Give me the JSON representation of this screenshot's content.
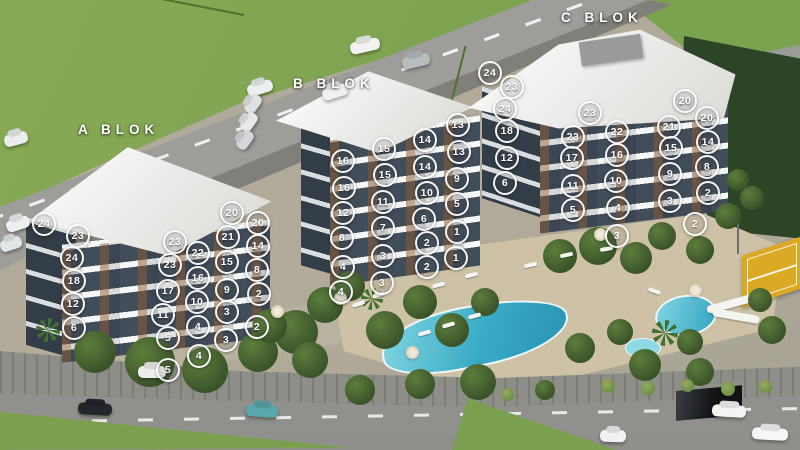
{
  "scene_title": "Residential complex 3D site plan with apartment unit markers",
  "blocks": [
    {
      "id": "A",
      "label": "A BLOK",
      "units": [
        {
          "n": "24",
          "x": 44,
          "y": 224
        },
        {
          "n": "23",
          "x": 78,
          "y": 236
        },
        {
          "n": "24",
          "x": 72,
          "y": 258
        },
        {
          "n": "18",
          "x": 74,
          "y": 281
        },
        {
          "n": "12",
          "x": 73,
          "y": 304
        },
        {
          "n": "6",
          "x": 74,
          "y": 328
        },
        {
          "n": "23",
          "x": 175,
          "y": 242
        },
        {
          "n": "23",
          "x": 170,
          "y": 265
        },
        {
          "n": "17",
          "x": 168,
          "y": 291
        },
        {
          "n": "11",
          "x": 163,
          "y": 315
        },
        {
          "n": "5",
          "x": 168,
          "y": 338
        },
        {
          "n": "5",
          "x": 168,
          "y": 370
        },
        {
          "n": "22",
          "x": 198,
          "y": 253
        },
        {
          "n": "16",
          "x": 198,
          "y": 278
        },
        {
          "n": "10",
          "x": 197,
          "y": 302
        },
        {
          "n": "4",
          "x": 198,
          "y": 327
        },
        {
          "n": "4",
          "x": 199,
          "y": 356
        },
        {
          "n": "20",
          "x": 232,
          "y": 213
        },
        {
          "n": "21",
          "x": 228,
          "y": 237
        },
        {
          "n": "15",
          "x": 227,
          "y": 262
        },
        {
          "n": "9",
          "x": 227,
          "y": 290
        },
        {
          "n": "3",
          "x": 227,
          "y": 312
        },
        {
          "n": "3",
          "x": 226,
          "y": 340
        },
        {
          "n": "20",
          "x": 258,
          "y": 223
        },
        {
          "n": "14",
          "x": 258,
          "y": 246
        },
        {
          "n": "8",
          "x": 257,
          "y": 270
        },
        {
          "n": "2",
          "x": 259,
          "y": 294
        },
        {
          "n": "2",
          "x": 257,
          "y": 327
        }
      ]
    },
    {
      "id": "B",
      "label": "B BLOK",
      "units": [
        {
          "n": "16",
          "x": 343,
          "y": 161
        },
        {
          "n": "16",
          "x": 344,
          "y": 188
        },
        {
          "n": "12",
          "x": 343,
          "y": 213
        },
        {
          "n": "8",
          "x": 342,
          "y": 238
        },
        {
          "n": "4",
          "x": 343,
          "y": 267
        },
        {
          "n": "4",
          "x": 341,
          "y": 292
        },
        {
          "n": "15",
          "x": 384,
          "y": 149
        },
        {
          "n": "15",
          "x": 385,
          "y": 175
        },
        {
          "n": "11",
          "x": 383,
          "y": 202
        },
        {
          "n": "7",
          "x": 383,
          "y": 228
        },
        {
          "n": "3",
          "x": 383,
          "y": 256
        },
        {
          "n": "3",
          "x": 382,
          "y": 283
        },
        {
          "n": "14",
          "x": 425,
          "y": 140
        },
        {
          "n": "14",
          "x": 425,
          "y": 167
        },
        {
          "n": "10",
          "x": 427,
          "y": 193
        },
        {
          "n": "6",
          "x": 424,
          "y": 219
        },
        {
          "n": "2",
          "x": 427,
          "y": 243
        },
        {
          "n": "2",
          "x": 427,
          "y": 267
        },
        {
          "n": "13",
          "x": 458,
          "y": 125
        },
        {
          "n": "13",
          "x": 459,
          "y": 152
        },
        {
          "n": "9",
          "x": 457,
          "y": 179
        },
        {
          "n": "5",
          "x": 457,
          "y": 204
        },
        {
          "n": "1",
          "x": 457,
          "y": 232
        },
        {
          "n": "1",
          "x": 456,
          "y": 258
        }
      ]
    },
    {
      "id": "C",
      "label": "C BLOK",
      "units": [
        {
          "n": "24",
          "x": 490,
          "y": 73
        },
        {
          "n": "23",
          "x": 512,
          "y": 87
        },
        {
          "n": "24",
          "x": 505,
          "y": 109
        },
        {
          "n": "18",
          "x": 507,
          "y": 131
        },
        {
          "n": "12",
          "x": 507,
          "y": 158
        },
        {
          "n": "6",
          "x": 505,
          "y": 183
        },
        {
          "n": "23",
          "x": 590,
          "y": 113
        },
        {
          "n": "23",
          "x": 573,
          "y": 137
        },
        {
          "n": "17",
          "x": 572,
          "y": 158
        },
        {
          "n": "11",
          "x": 573,
          "y": 186
        },
        {
          "n": "5",
          "x": 573,
          "y": 210
        },
        {
          "n": "22",
          "x": 617,
          "y": 132
        },
        {
          "n": "16",
          "x": 617,
          "y": 155
        },
        {
          "n": "10",
          "x": 616,
          "y": 181
        },
        {
          "n": "4",
          "x": 618,
          "y": 208
        },
        {
          "n": "3",
          "x": 617,
          "y": 236
        },
        {
          "n": "21",
          "x": 669,
          "y": 127
        },
        {
          "n": "15",
          "x": 671,
          "y": 148
        },
        {
          "n": "9",
          "x": 670,
          "y": 174
        },
        {
          "n": "3",
          "x": 670,
          "y": 201
        },
        {
          "n": "20",
          "x": 685,
          "y": 101
        },
        {
          "n": "20",
          "x": 707,
          "y": 118
        },
        {
          "n": "14",
          "x": 708,
          "y": 142
        },
        {
          "n": "8",
          "x": 707,
          "y": 167
        },
        {
          "n": "2",
          "x": 708,
          "y": 193
        },
        {
          "n": "2",
          "x": 695,
          "y": 224
        }
      ]
    }
  ],
  "colors": {
    "grass": "#7aa04f",
    "forest": "#2c4527",
    "road": "#9a9a97",
    "deck": "#cdc1a6",
    "pool_water": "#35a8c4",
    "facade_dark": "#424d5a",
    "wood_accent": "#8b5b33",
    "roof_white": "#f4f4f2",
    "court_yellow": "#dca925",
    "marker_ring": "#ffffff"
  }
}
